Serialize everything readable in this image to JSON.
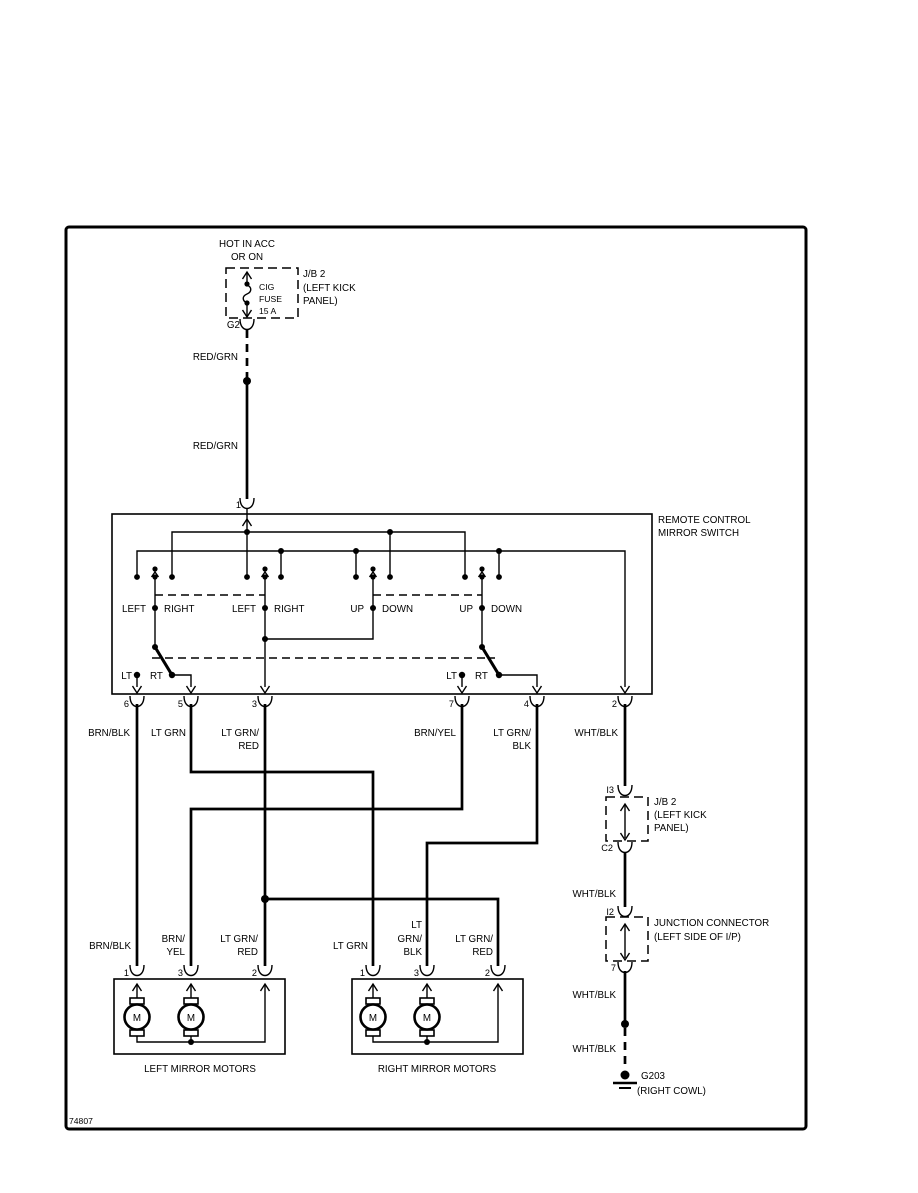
{
  "page": {
    "form_number": "74807"
  },
  "colors": {
    "ink": "#000000",
    "paper": "#ffffff"
  },
  "power": {
    "hot1": "HOT IN ACC",
    "hot2": "OR ON",
    "fuse1": "CIG",
    "fuse2": "FUSE",
    "fuse3": "15 A",
    "jb1": "J/B 2",
    "jb2": "(LEFT KICK",
    "jb3": "PANEL)",
    "g2": "G2",
    "wire_upper": "RED/GRN",
    "wire_lower": "RED/GRN",
    "pin1": "1"
  },
  "sw": {
    "title1": "REMOTE CONTROL",
    "title2": "MIRROR SWITCH",
    "s1l": "LEFT",
    "s1r": "RIGHT",
    "s2l": "LEFT",
    "s2r": "RIGHT",
    "s3l": "UP",
    "s3r": "DOWN",
    "s4l": "UP",
    "s4r": "DOWN",
    "lt": "LT",
    "rt": "RT",
    "p6": "6",
    "p5": "5",
    "p3": "3",
    "p7": "7",
    "p4": "4",
    "p2": "2"
  },
  "wires": {
    "w6": "BRN/BLK",
    "w5": "LT GRN",
    "w3a": "LT GRN/",
    "w3b": "RED",
    "w7": "BRN/YEL",
    "w4a": "LT GRN/",
    "w4b": "BLK",
    "w2": "WHT/BLK"
  },
  "lm": {
    "caption": "LEFT MIRROR MOTORS",
    "m": "M",
    "p1": "1",
    "p3": "3",
    "p2": "2",
    "w1": "BRN/BLK",
    "w3a": "BRN/",
    "w3b": "YEL",
    "w2a": "LT GRN/",
    "w2b": "RED"
  },
  "rm": {
    "caption": "RIGHT MIRROR MOTORS",
    "m": "M",
    "p1": "1",
    "p3": "3",
    "p2": "2",
    "w1": "LT GRN",
    "w3a": "LT",
    "w3b": "GRN/",
    "w3c": "BLK",
    "w2a": "LT GRN/",
    "w2b": "RED"
  },
  "gnd": {
    "i3": "I3",
    "jb1": "J/B 2",
    "jb2": "(LEFT KICK",
    "jb3": "PANEL)",
    "c2": "C2",
    "wa": "WHT/BLK",
    "i2": "I2",
    "jc1": "JUNCTION CONNECTOR",
    "jc2": "(LEFT SIDE OF I/P)",
    "p7": "7",
    "wb": "WHT/BLK",
    "wc": "WHT/BLK",
    "g203": "G203",
    "loc": "(RIGHT COWL)"
  }
}
